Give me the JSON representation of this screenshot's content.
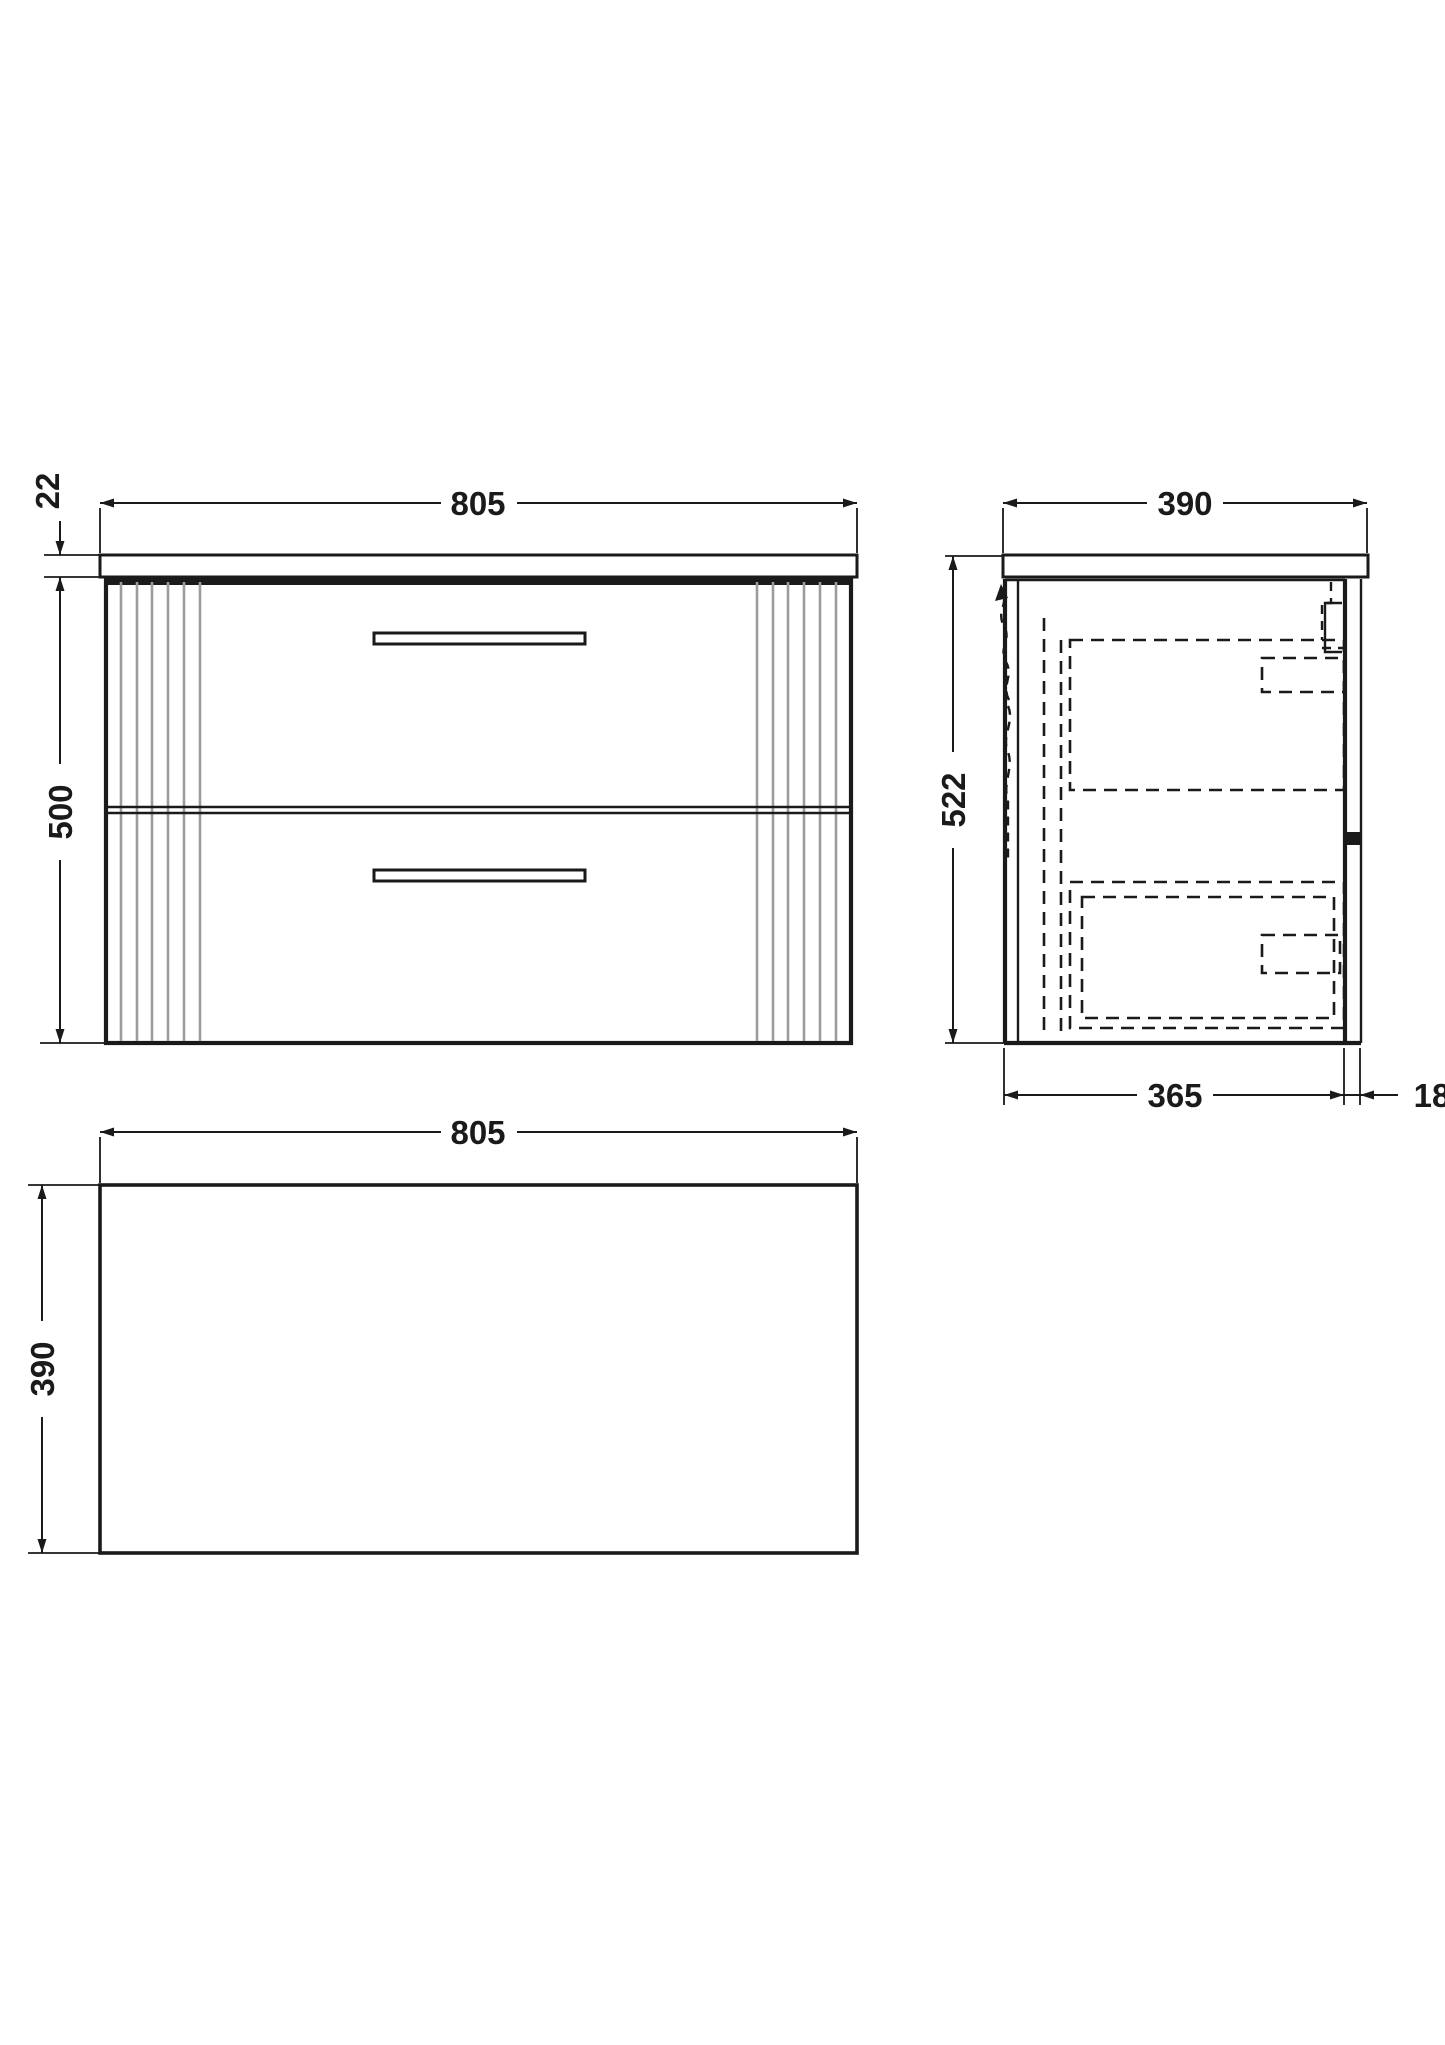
{
  "page": {
    "background": "#ffffff"
  },
  "colors": {
    "line": "#1a1a1a",
    "flute": "#9c9c9c"
  },
  "drawing_type": "vanity-unit-technical-drawing",
  "views": {
    "front": {
      "title": "front-elevation",
      "width_mm": "805",
      "counter_thickness_mm": "22",
      "height_mm": "500"
    },
    "side": {
      "title": "side-section",
      "depth_mm": "390",
      "height_mm": "522",
      "body_depth_mm": "365",
      "back_gap_mm": "18"
    },
    "plan": {
      "title": "plan-view",
      "width_mm": "805",
      "depth_mm": "390"
    }
  }
}
